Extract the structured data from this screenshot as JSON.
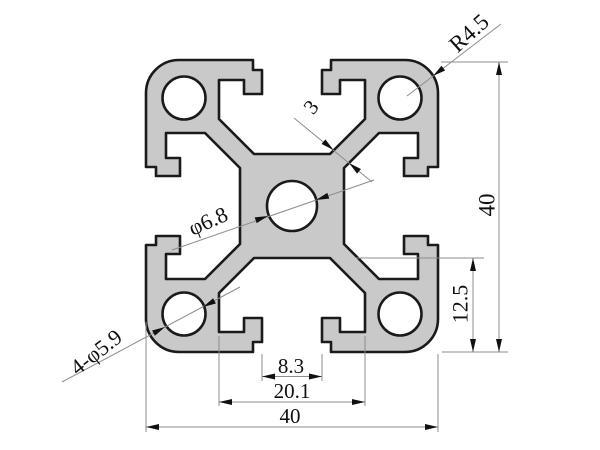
{
  "drawing": {
    "labels": {
      "corner_radius": "R4.5",
      "web_thickness": "3",
      "center_hole_dia": "φ6.8",
      "corner_holes_dia": "4-φ5.9",
      "overall_height": "40",
      "slot_depth": "12.5",
      "slot_opening": "8.3",
      "cavity_width": "20.1",
      "overall_width": "40"
    },
    "colors": {
      "background": "#ffffff",
      "profile_fill": "#c9c9c9",
      "outline": "#1a1a1a",
      "dim_lines": "#8c8c8c",
      "dim_text": "#111111"
    }
  }
}
